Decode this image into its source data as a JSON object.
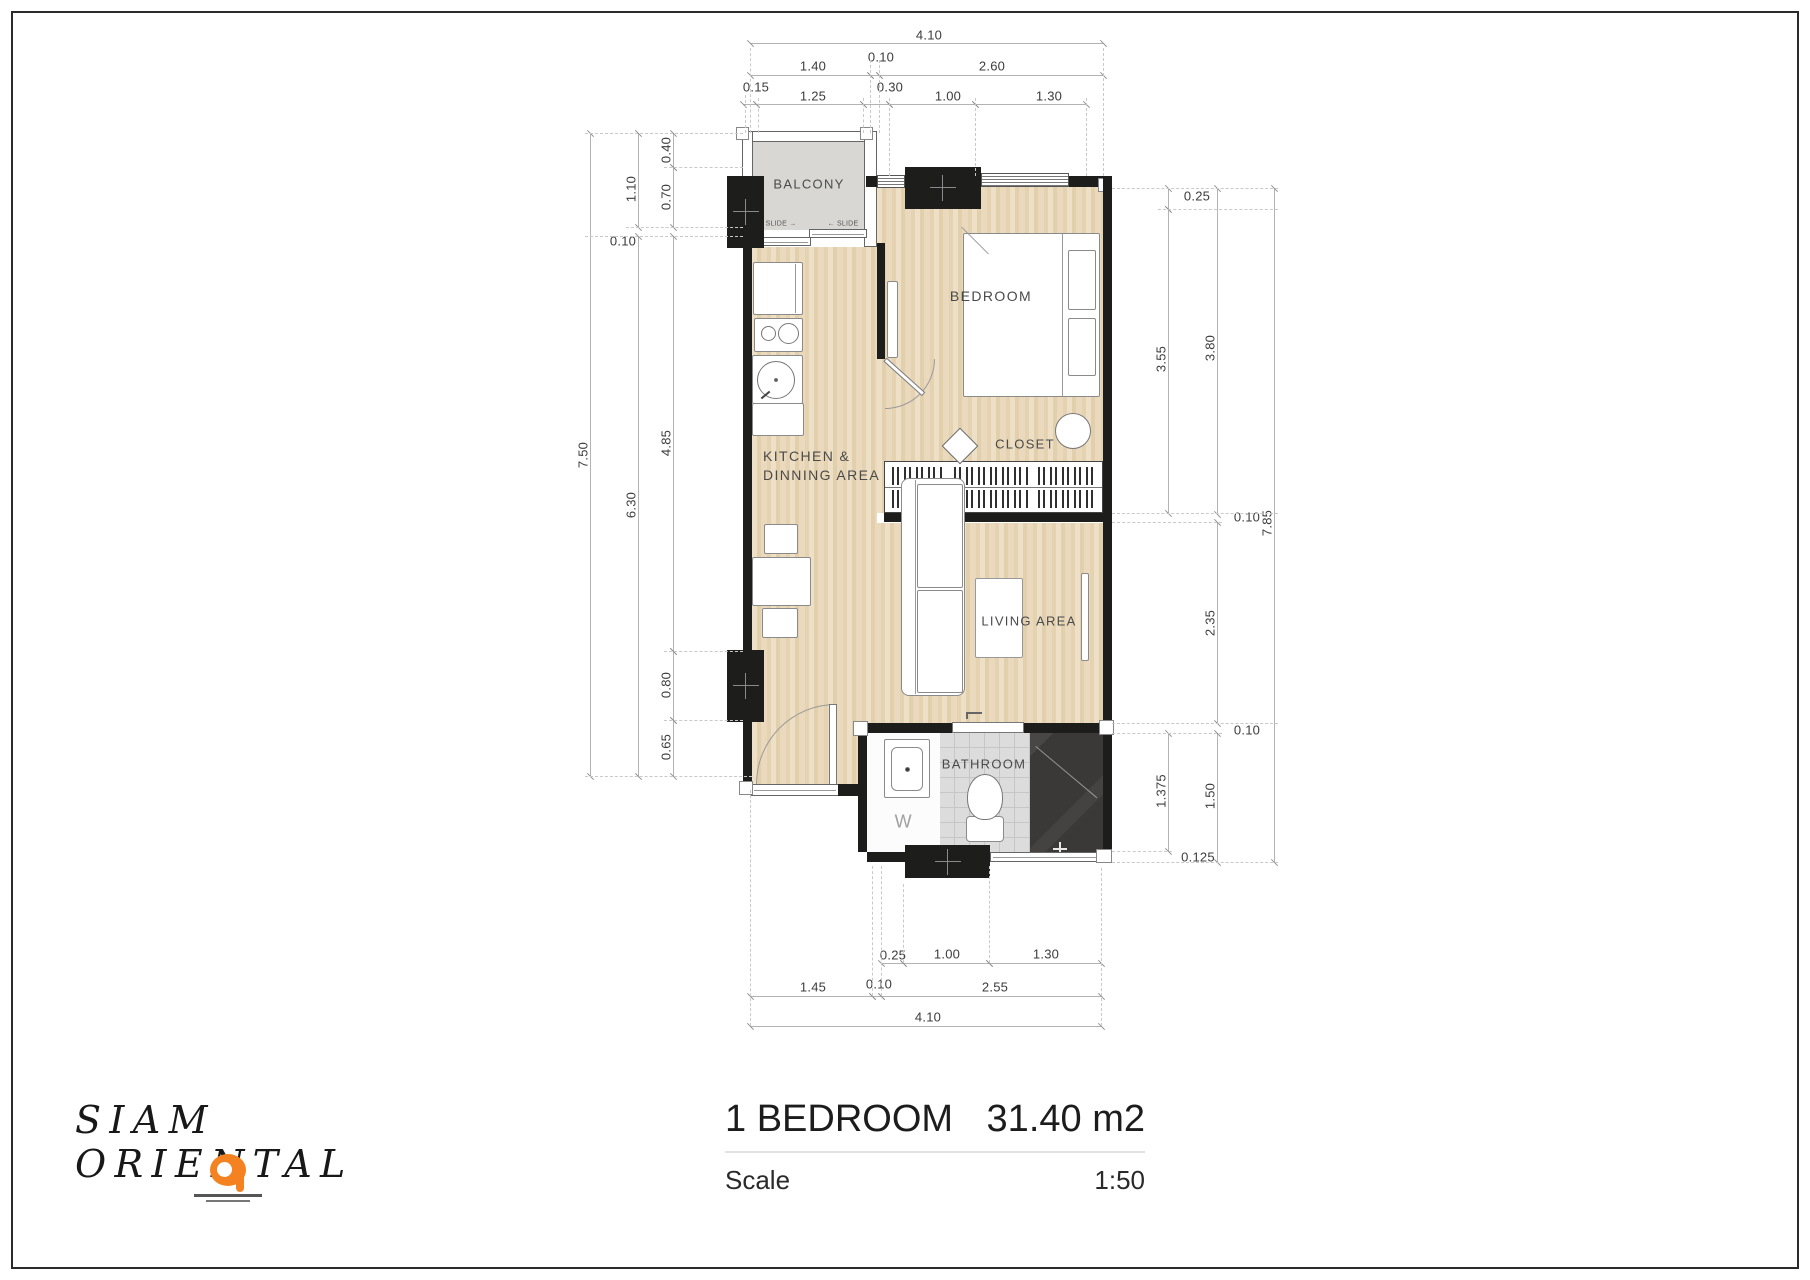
{
  "brand": {
    "name": "SIAM ORIENTAL",
    "logo_color": "#f58220"
  },
  "title_block": {
    "unit_type": "1 BEDROOM",
    "area": "31.40 m2",
    "scale_label": "Scale",
    "scale_value": "1:50"
  },
  "plan": {
    "room_labels": [
      {
        "text": "BALCONY",
        "x": 809,
        "y": 184,
        "size": 13
      },
      {
        "text": "BEDROOM",
        "x": 991,
        "y": 296,
        "size": 14
      },
      {
        "text": "KITCHEN &",
        "x": 763,
        "y": 456,
        "size": 14,
        "anchor": "start"
      },
      {
        "text": "DINNING AREA",
        "x": 763,
        "y": 475,
        "size": 14,
        "anchor": "start"
      },
      {
        "text": "CLOSET",
        "x": 1025,
        "y": 444,
        "size": 13
      },
      {
        "text": "LIVING AREA",
        "x": 1029,
        "y": 621,
        "size": 13
      },
      {
        "text": "BATHROOM",
        "x": 984,
        "y": 764,
        "size": 13
      },
      {
        "text": "W",
        "x": 904,
        "y": 822,
        "size": 18,
        "color": "#a0a0a0"
      }
    ],
    "slide_door_labels": [
      {
        "text": "SLIDE →",
        "x": 781,
        "y": 224
      },
      {
        "text": "← SLIDE",
        "x": 843,
        "y": 224
      }
    ],
    "dim_labels": [
      {
        "t": "4.10",
        "x": 929,
        "y": 35,
        "rot": false
      },
      {
        "t": "1.40",
        "x": 813,
        "y": 66,
        "rot": false
      },
      {
        "t": "0.10",
        "x": 881,
        "y": 57,
        "rot": false
      },
      {
        "t": "2.60",
        "x": 992,
        "y": 66,
        "rot": false
      },
      {
        "t": "0.15",
        "x": 756,
        "y": 87,
        "rot": false
      },
      {
        "t": "1.25",
        "x": 813,
        "y": 96,
        "rot": false
      },
      {
        "t": "0.30",
        "x": 890,
        "y": 87,
        "rot": false
      },
      {
        "t": "1.00",
        "x": 948,
        "y": 96,
        "rot": false
      },
      {
        "t": "1.30",
        "x": 1049,
        "y": 96,
        "rot": false
      },
      {
        "t": "7.50",
        "x": 583,
        "y": 455,
        "rot": true
      },
      {
        "t": "1.10",
        "x": 631,
        "y": 189,
        "rot": true
      },
      {
        "t": "6.30",
        "x": 631,
        "y": 505,
        "rot": true
      },
      {
        "t": "0.40",
        "x": 666,
        "y": 150,
        "rot": true
      },
      {
        "t": "0.70",
        "x": 666,
        "y": 197,
        "rot": true
      },
      {
        "t": "0.10",
        "x": 623,
        "y": 241,
        "rot": false
      },
      {
        "t": "4.85",
        "x": 666,
        "y": 443,
        "rot": true
      },
      {
        "t": "0.80",
        "x": 666,
        "y": 685,
        "rot": true
      },
      {
        "t": "0.65",
        "x": 666,
        "y": 747,
        "rot": true
      },
      {
        "t": "0.25",
        "x": 1197,
        "y": 196,
        "rot": false
      },
      {
        "t": "3.55",
        "x": 1161,
        "y": 359,
        "rot": true
      },
      {
        "t": "3.80",
        "x": 1210,
        "y": 348,
        "rot": true
      },
      {
        "t": "0.10",
        "x": 1247,
        "y": 517,
        "rot": false
      },
      {
        "t": "7.85",
        "x": 1267,
        "y": 523,
        "rot": true
      },
      {
        "t": "2.35",
        "x": 1210,
        "y": 623,
        "rot": true
      },
      {
        "t": "0.10",
        "x": 1247,
        "y": 730,
        "rot": false
      },
      {
        "t": "1.375",
        "x": 1161,
        "y": 791,
        "rot": true
      },
      {
        "t": "1.50",
        "x": 1210,
        "y": 796,
        "rot": true
      },
      {
        "t": "0.125",
        "x": 1198,
        "y": 857,
        "rot": false
      },
      {
        "t": "0.25",
        "x": 893,
        "y": 955,
        "rot": false
      },
      {
        "t": "1.00",
        "x": 947,
        "y": 954,
        "rot": false
      },
      {
        "t": "1.30",
        "x": 1046,
        "y": 954,
        "rot": false
      },
      {
        "t": "1.45",
        "x": 813,
        "y": 987,
        "rot": false
      },
      {
        "t": "0.10",
        "x": 879,
        "y": 984,
        "rot": false
      },
      {
        "t": "2.55",
        "x": 995,
        "y": 987,
        "rot": false
      },
      {
        "t": "4.10",
        "x": 928,
        "y": 1017,
        "rot": false
      }
    ]
  }
}
